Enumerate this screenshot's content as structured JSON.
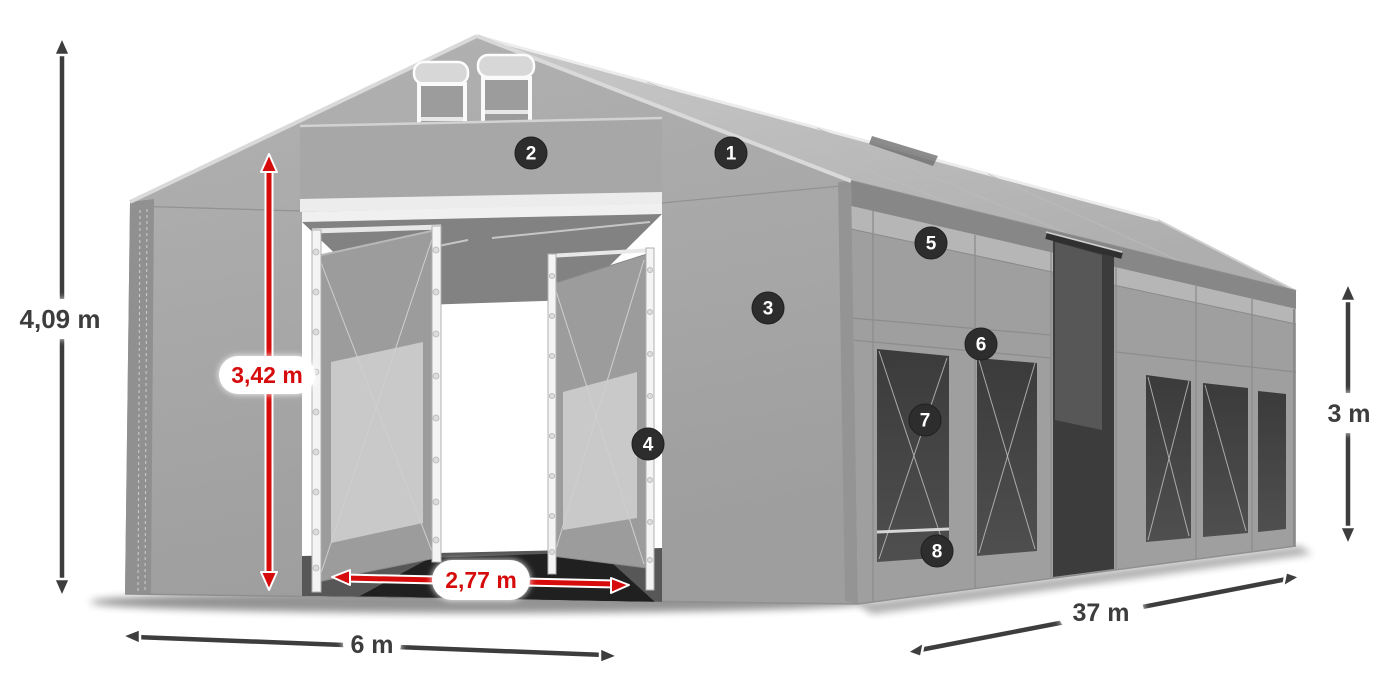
{
  "diagram": {
    "type": "product-dimension-diagram",
    "subject": "Gray PVC storage tent / marquee with open double entrance doors, gable vents and side windows",
    "background_color": "#ffffff"
  },
  "dimensions": {
    "total_height_label": "4,09 m",
    "entrance_height_label": "3,42 m",
    "entrance_width_label": "2,77 m",
    "width_label": "6 m",
    "length_label": "37 m",
    "side_height_label": "3 m"
  },
  "callouts": [
    {
      "number": "1"
    },
    {
      "number": "2"
    },
    {
      "number": "3"
    },
    {
      "number": "4"
    },
    {
      "number": "5"
    },
    {
      "number": "6"
    },
    {
      "number": "7"
    },
    {
      "number": "8"
    }
  ],
  "colors": {
    "dimension_red": "#d60b0b",
    "dimension_dark": "#3d3d3d",
    "badge_background": "#2d2d2d",
    "badge_text": "#ffffff",
    "fabric_gray": "#a2a2a2",
    "window_dark": "#454545"
  }
}
